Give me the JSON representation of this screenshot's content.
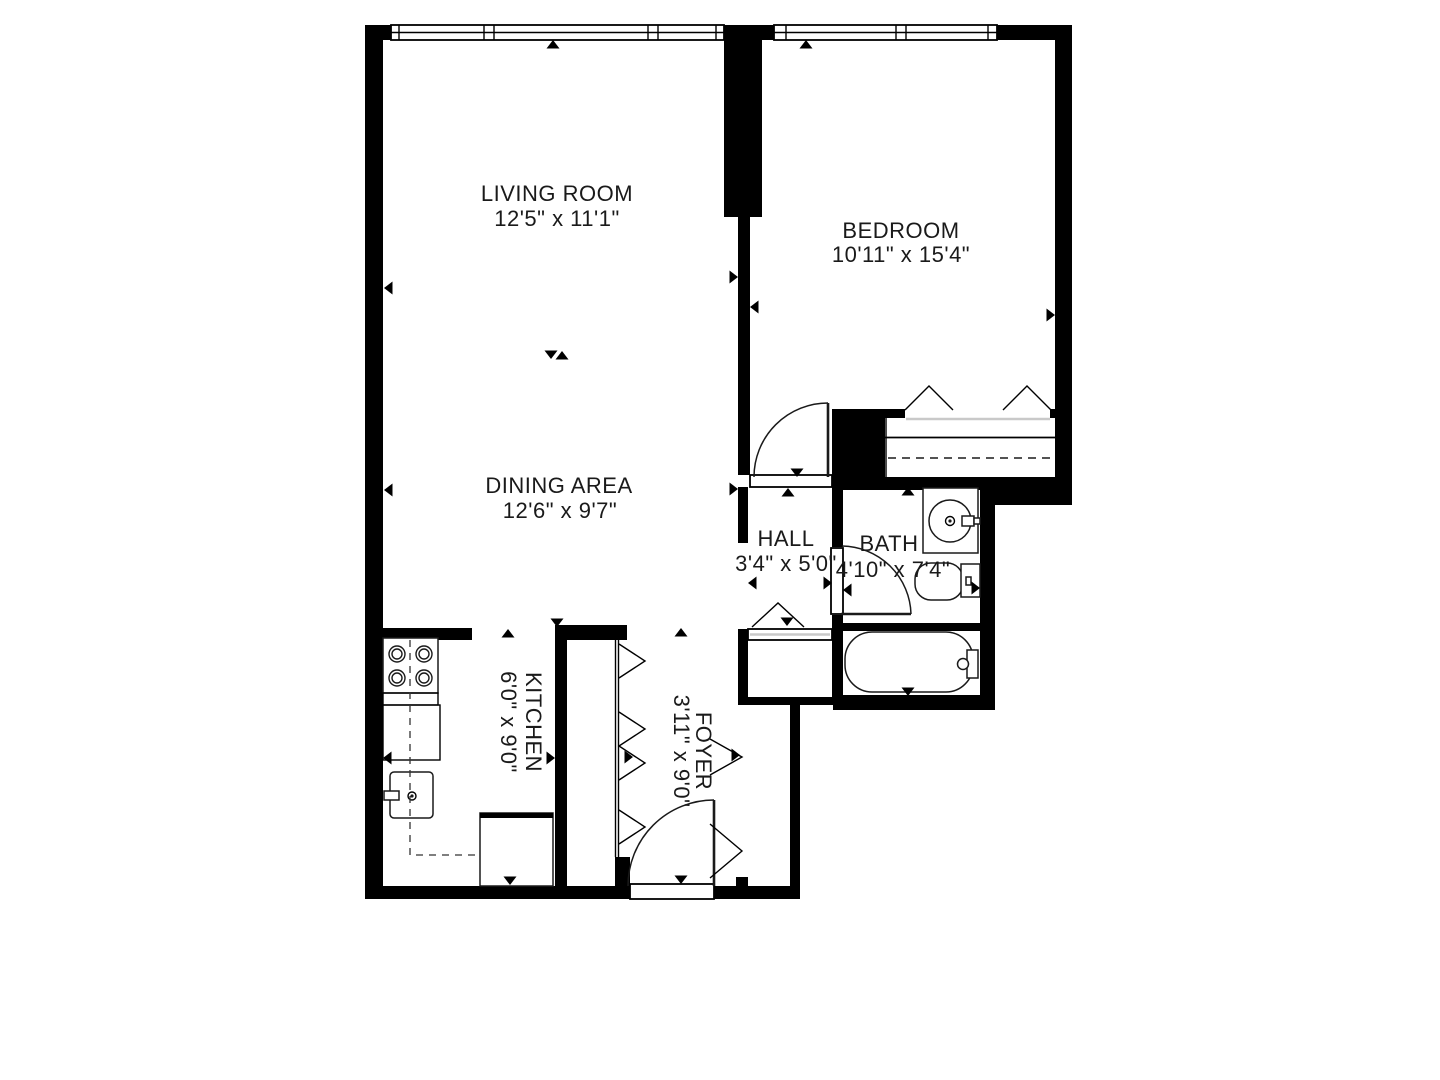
{
  "colors": {
    "background": "#ffffff",
    "walls": "#000000",
    "text": "#1a1a1a",
    "closet_track": "#c9c9c9"
  },
  "rooms": {
    "living_room": {
      "name": "LIVING ROOM",
      "dims": "12'5\" x 11'1\""
    },
    "bedroom": {
      "name": "BEDROOM",
      "dims": "10'11\" x 15'4\""
    },
    "dining_area": {
      "name": "DINING AREA",
      "dims": "12'6\" x 9'7\""
    },
    "hall": {
      "name": "HALL",
      "dims": "3'4\" x 5'0\""
    },
    "bath": {
      "name": "BATH",
      "dims": "4'10\" x 7'4\""
    },
    "kitchen": {
      "name": "KITCHEN",
      "dims": "6'0\" x 9'0\""
    },
    "foyer": {
      "name": "FOYER",
      "dims": "3'11\" x 9'0\""
    }
  },
  "fixtures": {
    "kitchen": [
      "stove-cooktop",
      "counter",
      "kitchen-sink",
      "refrigerator"
    ],
    "bath": [
      "bathroom-sink",
      "toilet",
      "bathtub"
    ],
    "symbols": [
      "window",
      "hinged-door",
      "bifold-closet-door",
      "hanging-rod-dashed-line",
      "dimension-arrow"
    ]
  }
}
